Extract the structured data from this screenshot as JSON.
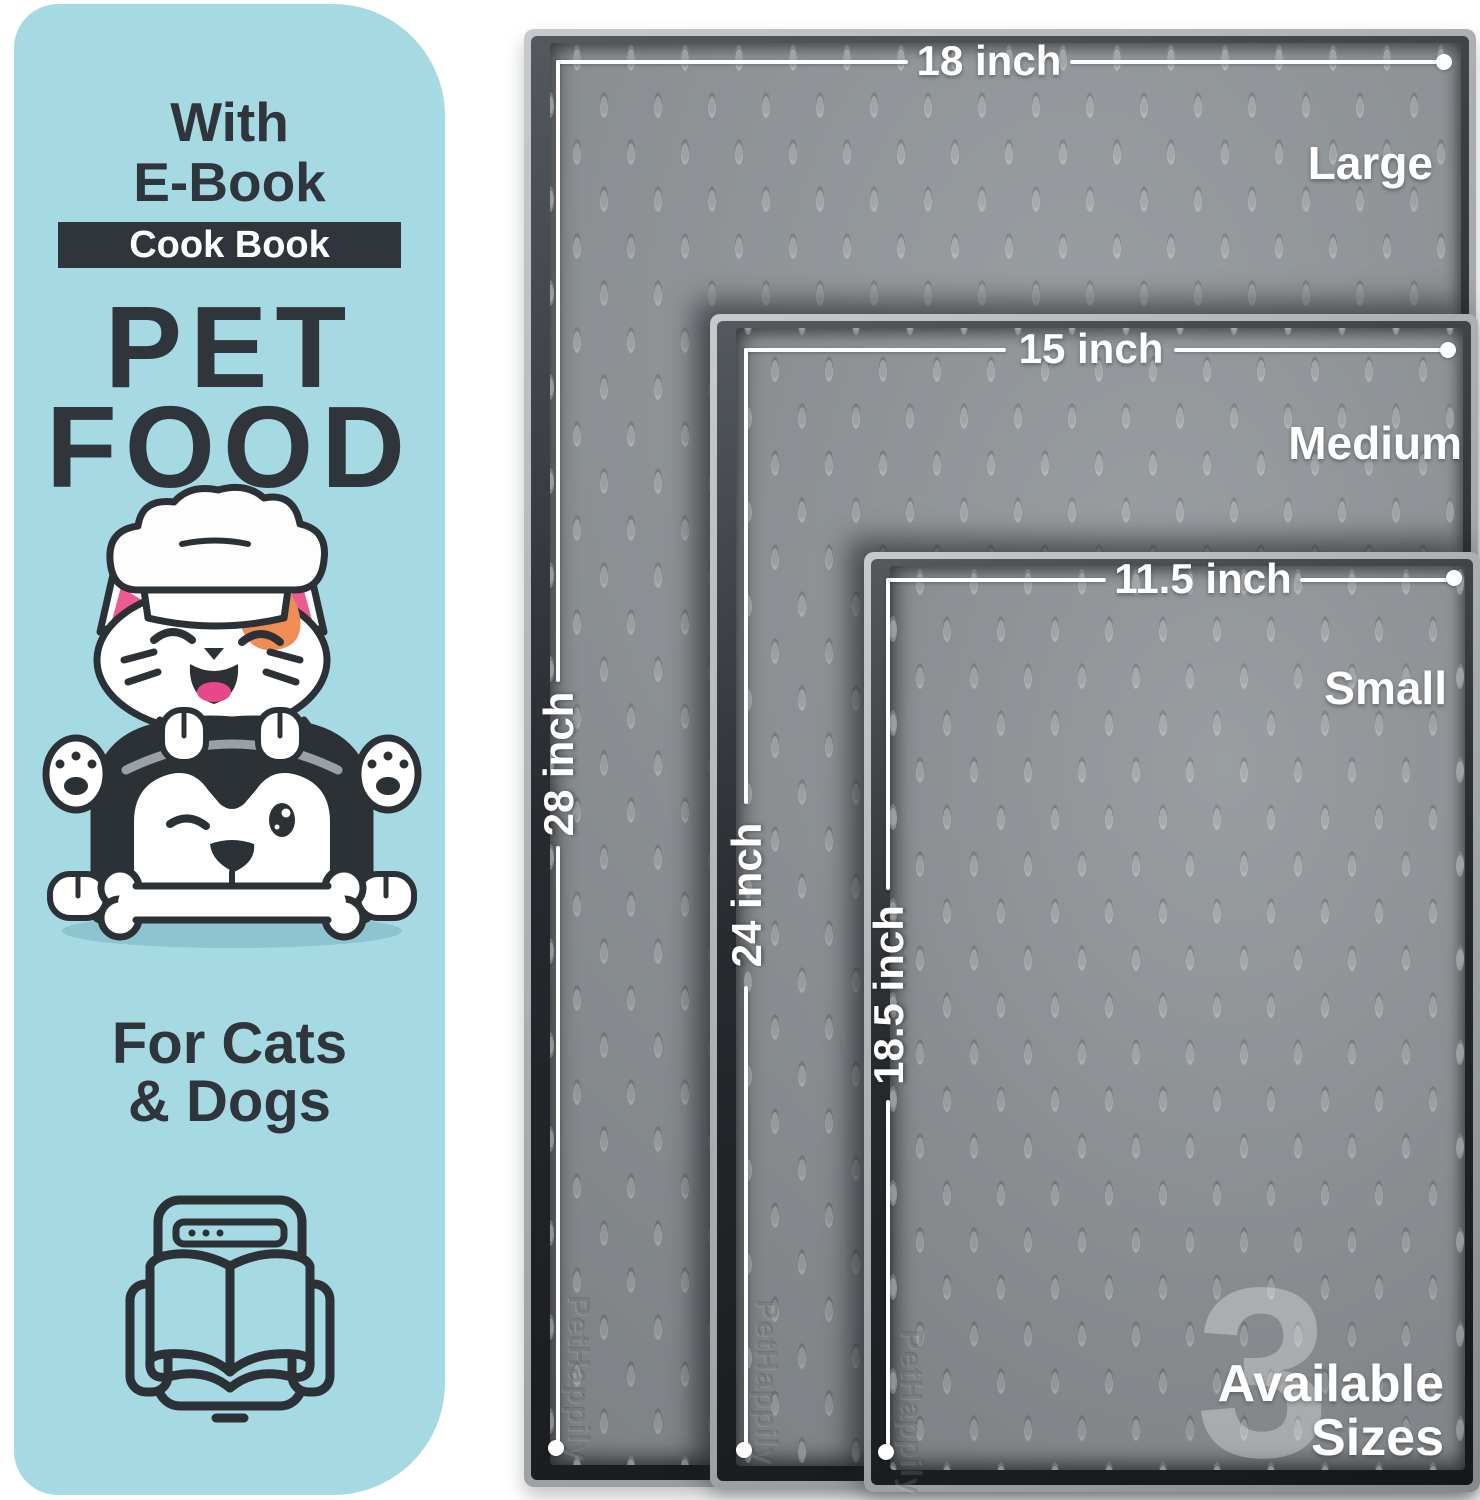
{
  "left_panel": {
    "bg_color": "#a6dae2",
    "eyebrow_line1": "With",
    "eyebrow_line2": "E-Book",
    "badge_label": "Cook Book",
    "title_line1": "PET",
    "title_line2": "FOOD",
    "subtitle_line1": "For Cats",
    "subtitle_line2": "& Dogs",
    "illustration": "cat-chef-on-husky-with-bone",
    "icon": "ebook-tablet-open-book-icon"
  },
  "mats": [
    {
      "name": "Large",
      "width_label": "18 inch",
      "height_label": "28 inch"
    },
    {
      "name": "Medium",
      "width_label": "15 inch",
      "height_label": "24 inch"
    },
    {
      "name": "Small",
      "width_label": "11.5 inch",
      "height_label": "18.5 inch"
    }
  ],
  "sizes_badge": {
    "count": "3",
    "caption_line1": "Available",
    "caption_line2": "Sizes"
  },
  "embossed_brand": "PetHappily",
  "colors": {
    "panel_bg": "#a6dae2",
    "ink": "#30353b",
    "mat_surface": "#8e9397",
    "mat_rim_dark": "#26292d",
    "mat_lip": "#a9aeb1",
    "measure_white": "#ffffff",
    "accent_pink": "#ec5a92",
    "accent_orange": "#ef8d55",
    "tongue_pink": "#e8488a",
    "shadow_blue": "#8cc4cf"
  }
}
